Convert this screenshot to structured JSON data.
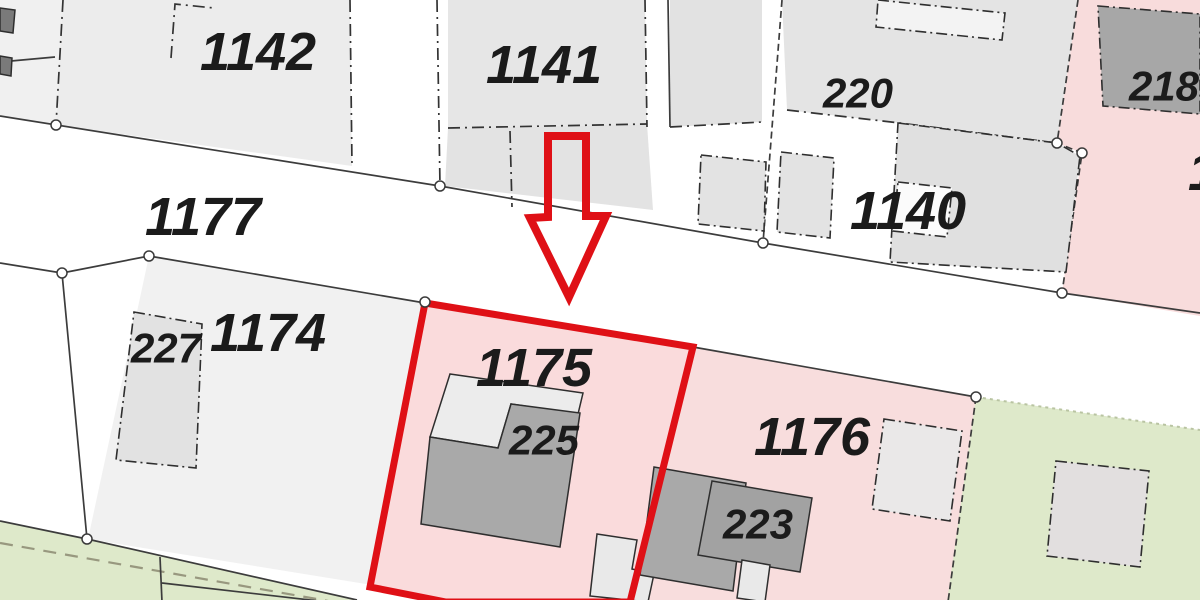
{
  "map": {
    "kind": "cadastral-parcel-plan",
    "highlighted_parcel": "1175",
    "colors": {
      "highlight_red": "#df1016",
      "parcel_pink": "#f8dcdc",
      "parcel_green": "#dee9ca",
      "parcel_gray": "#ececec",
      "building_dark_gray": "#a7a7a7",
      "road_white": "#ffffff",
      "boundary_line": "#3c3c3c",
      "label_text": "#1b1b1b"
    },
    "labels": [
      {
        "id": "parcel-1142",
        "text": "1142"
      },
      {
        "id": "parcel-1141",
        "text": "1141"
      },
      {
        "id": "building-220",
        "text": "220"
      },
      {
        "id": "building-218",
        "text": "218"
      },
      {
        "id": "parcel-partial-right",
        "text": "1"
      },
      {
        "id": "parcel-1140",
        "text": "1140"
      },
      {
        "id": "parcel-1177",
        "text": "1177"
      },
      {
        "id": "parcel-1174",
        "text": "1174"
      },
      {
        "id": "building-227",
        "text": "227"
      },
      {
        "id": "parcel-1175",
        "text": "1175"
      },
      {
        "id": "building-225",
        "text": "225"
      },
      {
        "id": "parcel-1176",
        "text": "1176"
      },
      {
        "id": "building-223",
        "text": "223"
      }
    ],
    "annotations": {
      "arrow": "red outline arrow pointing down at parcel 1175",
      "outline": "parcel 1175 outlined in thick red"
    }
  }
}
